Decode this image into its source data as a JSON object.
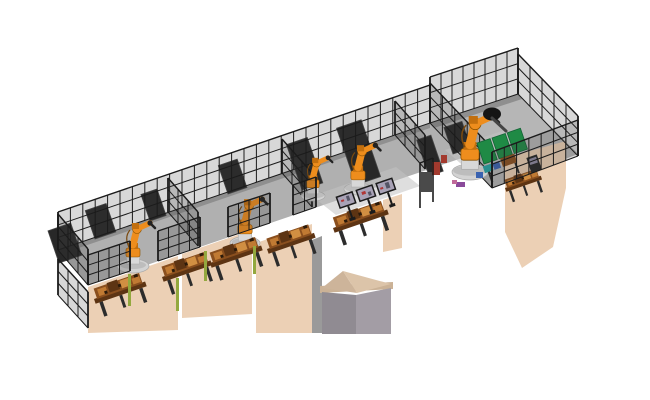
{
  "meta": {
    "description": "Isometric 3D render of a robotic engine assembly line with fenced robot cells",
    "background": "#ffffff",
    "robot_count": 5,
    "monitor_count": 3
  },
  "scene": {
    "cells": [
      {
        "id": "cell-1",
        "label": "robot-station-1",
        "equipment": [
          "6-axis-robot",
          "engine-workbench",
          "safety-fence"
        ]
      },
      {
        "id": "cell-2",
        "label": "robot-station-2",
        "equipment": [
          "6-axis-robot",
          "engine-workbench",
          "safety-fence"
        ]
      },
      {
        "id": "cell-3",
        "label": "dual-robot-station",
        "equipment": [
          "6-axis-robot",
          "6-axis-robot",
          "triple-monitor-hmi",
          "engine-workbench",
          "safety-fence"
        ]
      },
      {
        "id": "cell-4",
        "label": "large-robot-cell",
        "equipment": [
          "6-axis-robot",
          "green-panel-machine",
          "engine-part",
          "safety-fence",
          "gate"
        ]
      }
    ]
  },
  "colors": {
    "background": "#ffffff",
    "fence": "#1b1b1b",
    "fence_mesh": "rgba(60,60,60,0.20)",
    "floor": "#b0b0b0",
    "floor_right": "#b6b6b6",
    "floor_light": "#c2c2c2",
    "floor_shadow": "#8f8f8f",
    "turntable": "#d3d3d3",
    "turntable_edge": "#a8a8a8",
    "apron": "#ecd0b5",
    "apron_strip": "#9a9a9a",
    "cap_left": "#cdb49a",
    "cap_right": "#dcc4a9",
    "cap_band": "#cbb296",
    "block_left": "#908b92",
    "block_right": "#a39da5",
    "robot": "#ee8d1d",
    "robot_dark": "#c26f0e",
    "robot_outline": "#8a5200",
    "robot_joint": "#222222",
    "robot_pedestal": "#d8d8d8",
    "robot_cable": "#7a4a10",
    "bench_top": "#5d3413",
    "bench_body": "#8a4f1e",
    "bench_light": "#c07a33",
    "bench_light2": "#d18f42",
    "bench_dark_bit": "#2b1a0a",
    "bench_frame": "#2c2c2c",
    "monitor_frame": "#1b1b1b",
    "monitor_screen": "#a8a2b6",
    "screen_red": "#b03636",
    "screen_dark": "#555566",
    "green_panel": "#1f8a45",
    "green_dark": "#136336",
    "teal": "#2a8f8f",
    "blue": "#3a62b0",
    "red": "#a33a2e",
    "purple": "#8a4a9a",
    "pink": "#c06a9a",
    "cabinet": "#282828",
    "cabinet_edge": "#454545",
    "console": "#262626",
    "console_screen": "#8f8aa0",
    "curtain": "#93a83e",
    "head_black": "#151515",
    "tool_gray": "#444444"
  }
}
